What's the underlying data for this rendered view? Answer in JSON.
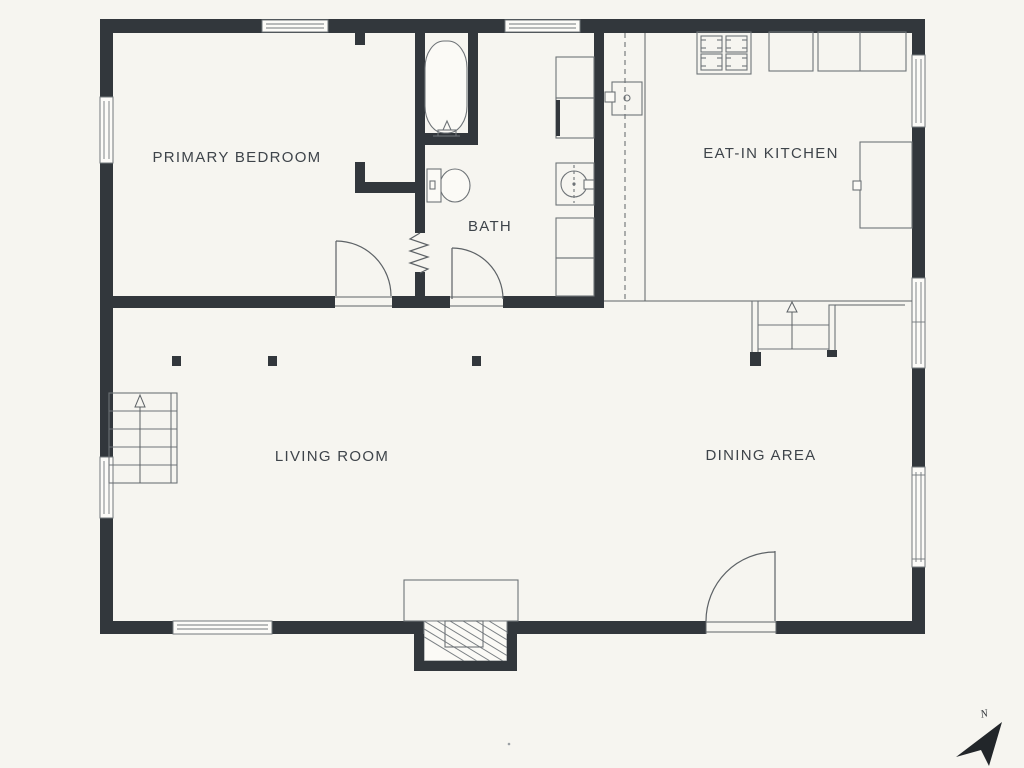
{
  "scene": {
    "type": "residential-floor-plan",
    "floor": "main"
  },
  "labels": {
    "primary_bedroom": "PRIMARY BEDROOM",
    "bath": "BATH",
    "eat_in_kitchen": "EAT-IN KITCHEN",
    "living_room": "LIVING ROOM",
    "dining_area": "DINING AREA"
  },
  "compass": {
    "label": "N",
    "direction": "north-east"
  },
  "fixtures": [
    "bathtub",
    "toilet",
    "washer",
    "laundry-cabinets",
    "kitchen-sink",
    "stove-4-burner",
    "kitchen-counters",
    "refrigerator",
    "fireplace",
    "stairs-up",
    "stairs-down",
    "structural-columns",
    "hinged-doors",
    "windows"
  ],
  "colors": {
    "background": "#f6f5f0",
    "wall": "#32373c",
    "line": "#5d6266",
    "fixture_line": "#6e7377",
    "text": "#3e444a"
  }
}
